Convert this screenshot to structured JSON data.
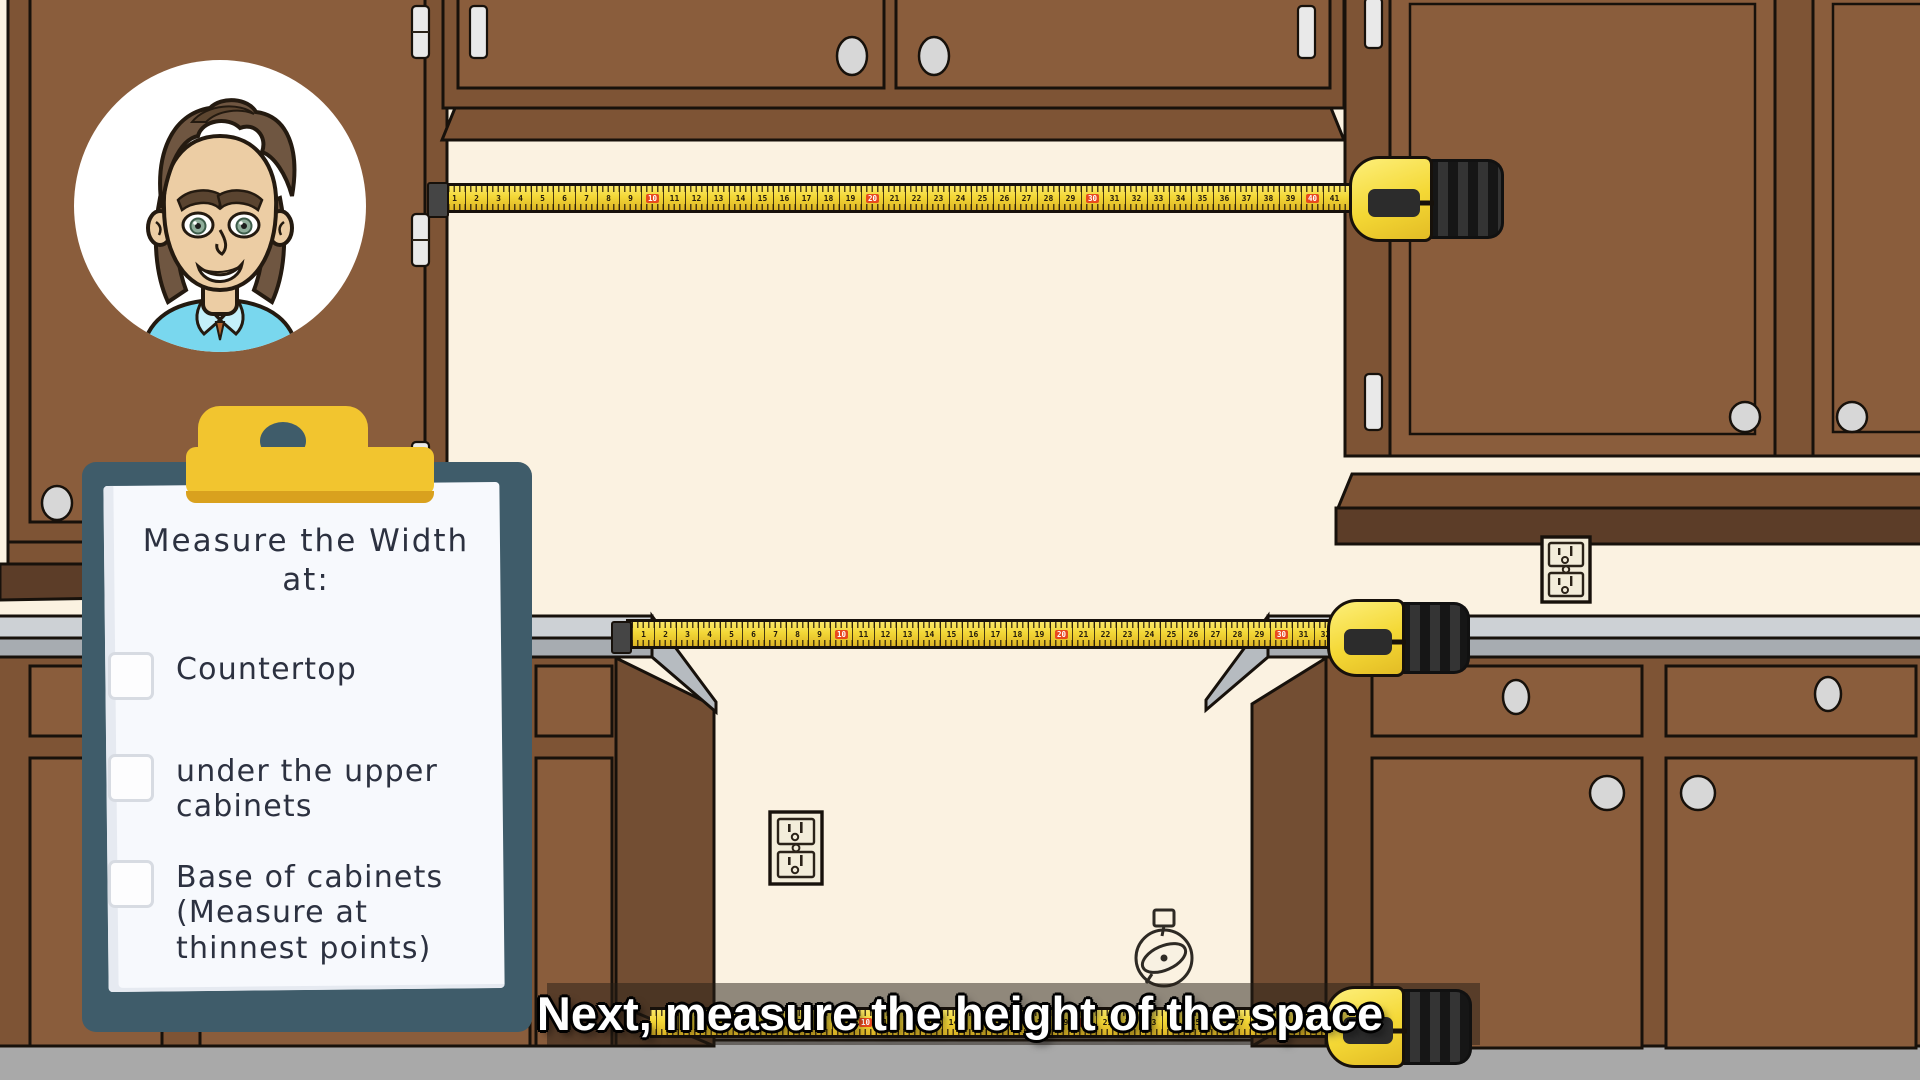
{
  "title": "Kitchen measuring tutorial frame",
  "caption": {
    "text": "Next, measure the height of the space"
  },
  "clipboard": {
    "title": "Measure the Width",
    "title_line2": "at:",
    "items": [
      {
        "label": "Countertop",
        "checked": false
      },
      {
        "label": "under the upper cabinets",
        "checked": false
      },
      {
        "label": "Base of cabinets (Measure at thinnest points)",
        "checked": false
      }
    ]
  },
  "tapes": {
    "top": {
      "start": 1,
      "end": 41,
      "red_every": 10
    },
    "middle": {
      "start": 1,
      "end": 32,
      "red_every": 10
    },
    "bottom": {
      "start": 1,
      "end": 30,
      "red_every": 10
    }
  },
  "icons": {
    "avatar": "narrator-avatar",
    "dish": "dish-icon",
    "outlet_upper": "power-outlet",
    "outlet_lower": "power-outlet",
    "checkbox": "empty-checkbox"
  },
  "colors": {
    "wall": "#fbf2e1",
    "floor": "#a9a9a9",
    "outline": "#17110b",
    "frame": "#7e5435",
    "door": "#8a5d3c",
    "side": "#734e33",
    "soffit": "#5c3d28",
    "counter-top": "#cdd1d5",
    "counter-edge": "#a7acb1",
    "counter-wedge": "#b6bbc0",
    "knob": "#d7d7d7",
    "hinge": "#e9e9e9",
    "tape-yellow": "#f3d737",
    "tape-red": "#e8491d",
    "case-black": "#262626",
    "board": "#3f5c6a",
    "clip-gold": "#f2c52f",
    "clip-shadow": "#d9a11e",
    "paper": "#f7f9fd",
    "ink": "#2c3140",
    "caption-band": "rgba(38,30,22,.5)",
    "skin": "#eccda4",
    "hair": "#6f5641",
    "shirt": "#79d7ee",
    "eye-green": "#8fae9b",
    "outlet-face": "#f3edda"
  }
}
